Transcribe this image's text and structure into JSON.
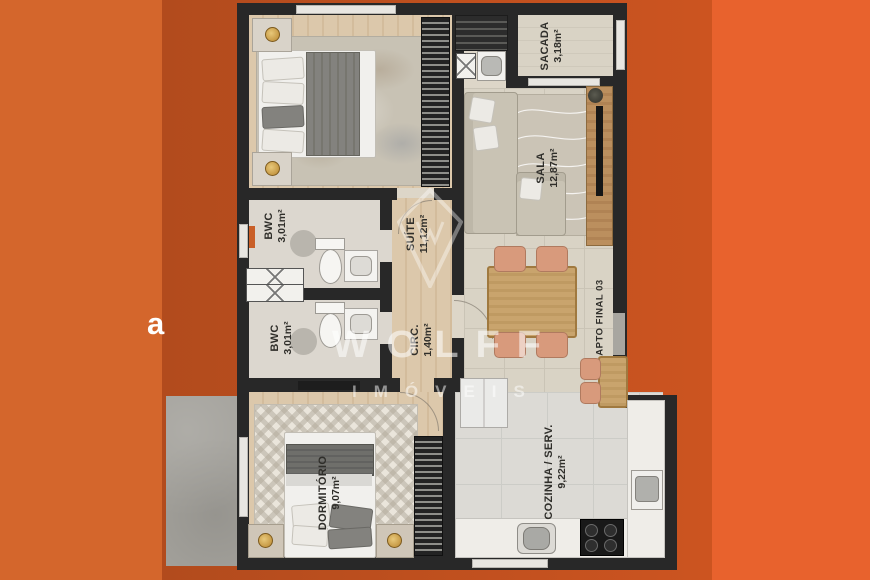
{
  "watermark": {
    "brand": "WOLFF",
    "tagline": "IMÓVEIS"
  },
  "unit_label": "APTO FINAL 03",
  "edge_text": "a",
  "rooms": [
    {
      "name": "SACADA",
      "area": "3,18m²"
    },
    {
      "name": "SALA",
      "area": "12,87m²"
    },
    {
      "name": "SUÍTE",
      "area": "11,12m²"
    },
    {
      "name": "BWC",
      "area": "3,01m²"
    },
    {
      "name": "BWC",
      "area": "3,01m²"
    },
    {
      "name": "CIRC.",
      "area": "1,40m²"
    },
    {
      "name": "DORMITÓRIO",
      "area": "9,07m²"
    },
    {
      "name": "COZINHA / SERV.",
      "area": "9,22m²"
    }
  ],
  "colors": {
    "background_left": "#d4662c",
    "background_mid": "#bb4e1e",
    "background_right": "#e8622d",
    "wall": "#282828",
    "wood_floor": "#d8c3a6",
    "accent_chair": "#d89a7c",
    "watermark_white": "#ffffff"
  }
}
